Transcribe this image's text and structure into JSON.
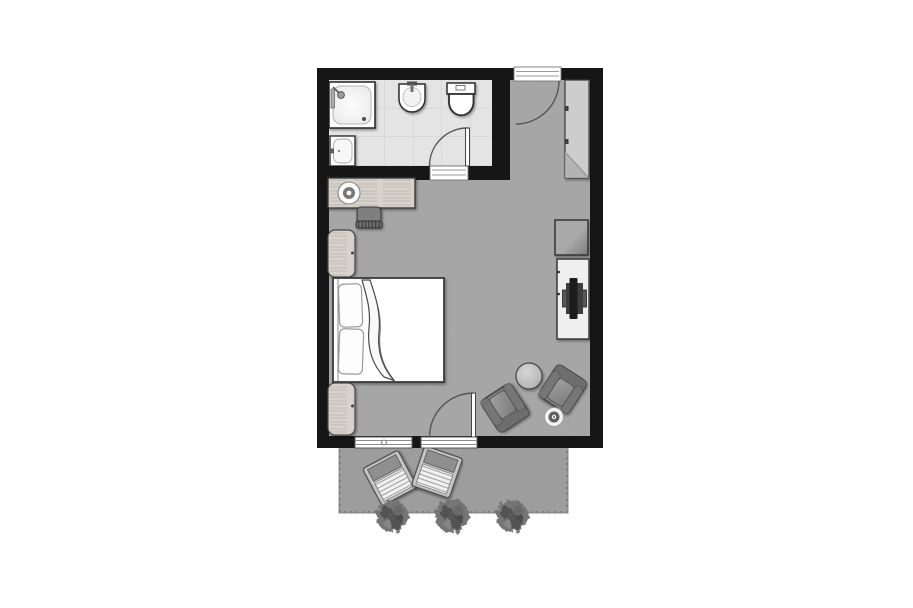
{
  "canvas": {
    "width": 913,
    "height": 608,
    "background": "#ffffff"
  },
  "colors": {
    "pageBg": "#ffffff",
    "wall": "#161616",
    "carpet": "#c9c9c9",
    "bathroomFloor": "#f4f4f4",
    "tileLine": "#dcdcdc",
    "terrace": "#b4b4b4",
    "terraceEdge": "#7f7f7f",
    "woodBase": "#d7d3cc",
    "woodGrain": "#c0bab0",
    "fixtureFill": "#ffffff",
    "fixtureOutline": "#2d2d2d",
    "innerFixture": "#efefef",
    "chairBody": "#7f7f7f",
    "wardrobe": "#cdcdcd",
    "minibarLight": "#a9a9a9",
    "minibarDark": "#7c7c7c",
    "console": "#efefef",
    "tvDark": "#1a1a1a",
    "tableFill": "#c6c6c6",
    "bushFill": "#747474",
    "bushDark": "#525252",
    "doorArc": "#555555",
    "loungerFrame": "#c6c6c6",
    "loungerBack": "#8f8f8f",
    "slatLine": "#9a9a9a"
  },
  "plan": {
    "type": "hotel-room-floor-plan",
    "rooms": [
      {
        "name": "bathroom",
        "items": [
          "shower",
          "vanity-sink",
          "bidet",
          "toilet",
          "swing-door",
          "tiled-floor"
        ]
      },
      {
        "name": "bedroom",
        "items": [
          "entry-door",
          "wardrobe",
          "desk",
          "desk-chair",
          "round-tray",
          "nightstand",
          "double-bed",
          "pillows",
          "duvet",
          "bench",
          "minibar",
          "tv-sideboard",
          "tv",
          "coffee-table",
          "armchair-left",
          "armchair-right",
          "floor-lamp",
          "window",
          "terrace-door",
          "carpet-floor"
        ]
      },
      {
        "name": "terrace",
        "items": [
          "deck",
          "sun-lounger-left",
          "sun-lounger-right",
          "shrub-left",
          "shrub-middle",
          "shrub-right"
        ]
      }
    ]
  }
}
